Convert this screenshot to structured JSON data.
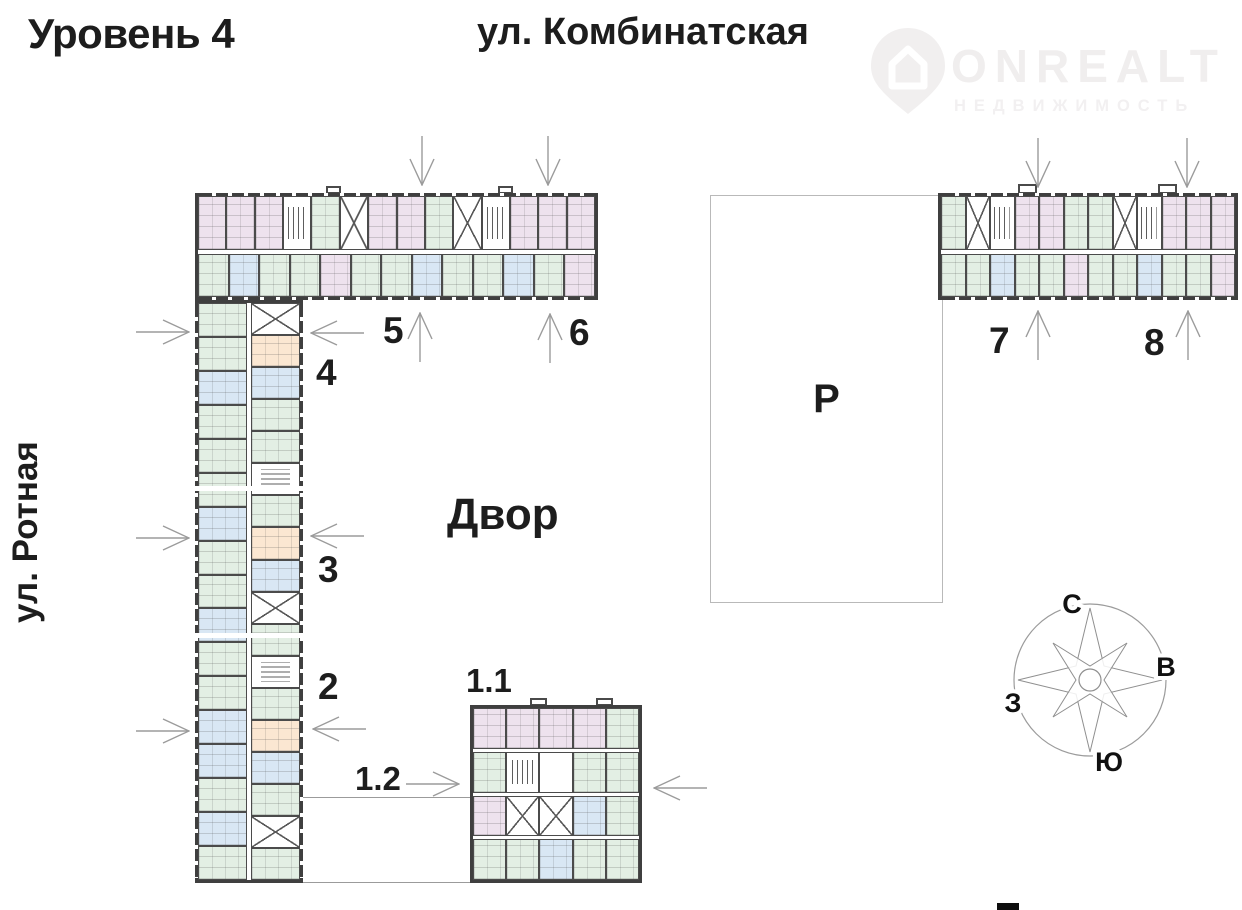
{
  "header": {
    "level_title": "Уровень 4"
  },
  "streets": {
    "top": "ул. Комбинатская",
    "left": "ул. Ротная"
  },
  "labels": {
    "courtyard": "Двор",
    "parking": "Р"
  },
  "sections": {
    "s1_1": "1.1",
    "s1_2": "1.2",
    "s2": "2",
    "s3": "3",
    "s4": "4",
    "s5": "5",
    "s6": "6",
    "s7": "7",
    "s8": "8"
  },
  "compass": {
    "n": "С",
    "e": "В",
    "s": "Ю",
    "w": "З"
  },
  "watermark": {
    "brand": "ONREALT",
    "tagline": "НЕДВИЖИМОСТЬ"
  },
  "palette": {
    "pink": "#eee2ee",
    "green": "#e3efe4",
    "blue": "#d9e7f4",
    "peach": "#fbe7d2",
    "wall": "#3f3f3f",
    "arrow": "#9b9b9b",
    "text": "#1d1d1d",
    "watermark_gray": "#f1efef"
  },
  "buildings": {
    "wing_horizontal": {
      "rows": [
        [
          "pink",
          "pink",
          "pink",
          "stair",
          "green",
          "elev",
          "pink",
          "pink",
          "green",
          "elev",
          "stair",
          "pink",
          "pink",
          "pink"
        ],
        [
          "green",
          "blue",
          "green",
          "green",
          "pink",
          "green",
          "green",
          "blue",
          "green",
          "green",
          "blue",
          "green",
          "pink"
        ]
      ]
    },
    "wing_vertical": {
      "rows": [
        [
          "green",
          "green",
          "blue",
          "green",
          "green",
          "green",
          "blue",
          "green",
          "green",
          "blue",
          "green",
          "green",
          "blue",
          "blue",
          "green",
          "blue",
          "green"
        ],
        [
          "elev",
          "peach",
          "blue",
          "green",
          "green",
          "stair",
          "green",
          "peach",
          "blue",
          "elev",
          "green",
          "stair",
          "green",
          "peach",
          "blue",
          "green",
          "elev",
          "green"
        ]
      ]
    },
    "building_78": {
      "rows": [
        [
          "green",
          "elev",
          "stair",
          "pink",
          "pink",
          "green",
          "green",
          "elev",
          "stair",
          "pink",
          "pink",
          "pink"
        ],
        [
          "green",
          "green",
          "blue",
          "green",
          "green",
          "pink",
          "green",
          "green",
          "blue",
          "green",
          "green",
          "pink"
        ]
      ]
    },
    "building_11": {
      "rows": [
        [
          "pink",
          "pink",
          "pink",
          "pink",
          "green"
        ],
        [
          "green",
          "stair",
          "core",
          "green",
          "green"
        ],
        [
          "pink",
          "elev",
          "elev",
          "blue",
          "green"
        ],
        [
          "green",
          "green",
          "blue",
          "green",
          "green"
        ]
      ]
    }
  }
}
